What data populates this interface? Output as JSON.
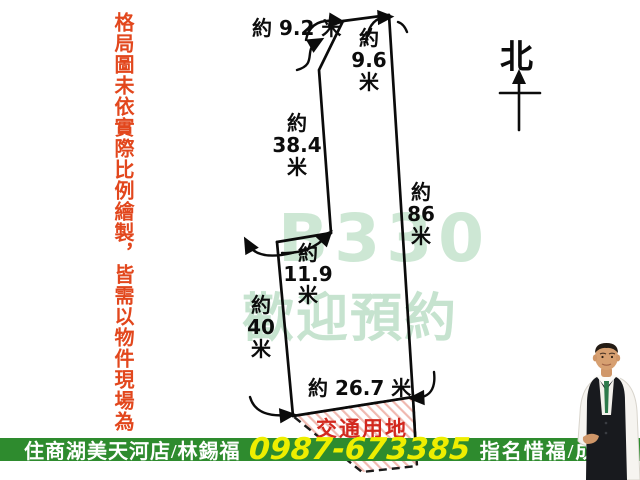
{
  "disclaimer": {
    "text": "格局圖未依實際比例繪製，皆需以物件現場為"
  },
  "north": {
    "label": "北"
  },
  "watermark": {
    "line1": "B330",
    "line2": "歡迎預約",
    "color": "#cde7d4"
  },
  "dimensions": {
    "top": "約 9.2 米",
    "top_right": "約\n9.6\n米",
    "upper_left": "約\n38.4\n米",
    "right": "約\n86\n米",
    "step": "約\n11.9\n米",
    "lower_left": "約\n40\n米",
    "bottom": "約 26.7 米"
  },
  "zone": {
    "label": "交通用地",
    "color": "#d2281e"
  },
  "footer": {
    "store": "住商湖美天河店/林錫福",
    "phone": "0987-673385",
    "slogan": "指名惜福/成交最快",
    "bar_color": "#2e8b2e",
    "phone_color": "#eeee00"
  }
}
